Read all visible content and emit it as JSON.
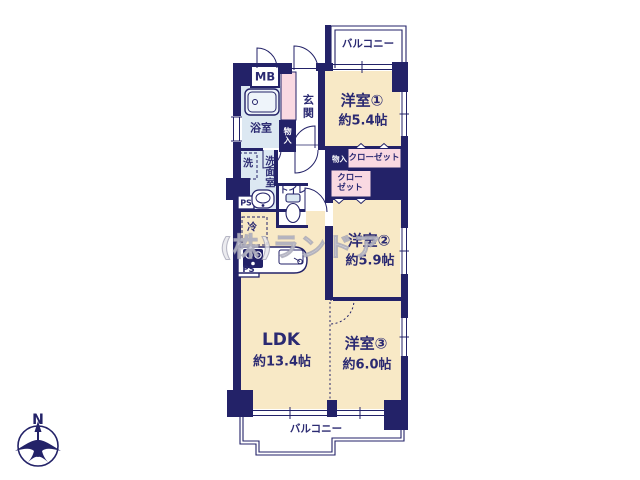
{
  "watermark": "(株)ランドア",
  "compass": {
    "north": "N"
  },
  "balconies": {
    "top": "バルコニー",
    "bottom": "バルコニー"
  },
  "rooms": {
    "room1": {
      "name": "洋室①",
      "size": "約5.4帖"
    },
    "room2": {
      "name": "洋室②",
      "size": "約5.9帖"
    },
    "room3": {
      "name": "洋室③",
      "size": "約6.0帖"
    },
    "ldk": {
      "name": "LDK",
      "size": "約13.4帖"
    },
    "genkan": {
      "name": "玄関"
    },
    "bathroom": {
      "name": "浴室"
    },
    "washroom": {
      "name": "洗面室"
    },
    "toilet": {
      "name": "トイレ"
    }
  },
  "fixtures": {
    "meter_box": "MB",
    "pipe_space_1": "PS",
    "pipe_space_2": "PS",
    "washer": "洗",
    "fridge": "冷",
    "storage_1": "物入",
    "storage_2": "物入",
    "closet_1": "クローゼット",
    "closet_2_line1": "クロー",
    "closet_2_line2": "ゼット"
  },
  "colors": {
    "wall": "#232268",
    "room_fill": "#f8e9c6",
    "closet_fill": "#f9d9e2",
    "wet_fill": "#dce8f2",
    "text": "#2b2a72"
  }
}
